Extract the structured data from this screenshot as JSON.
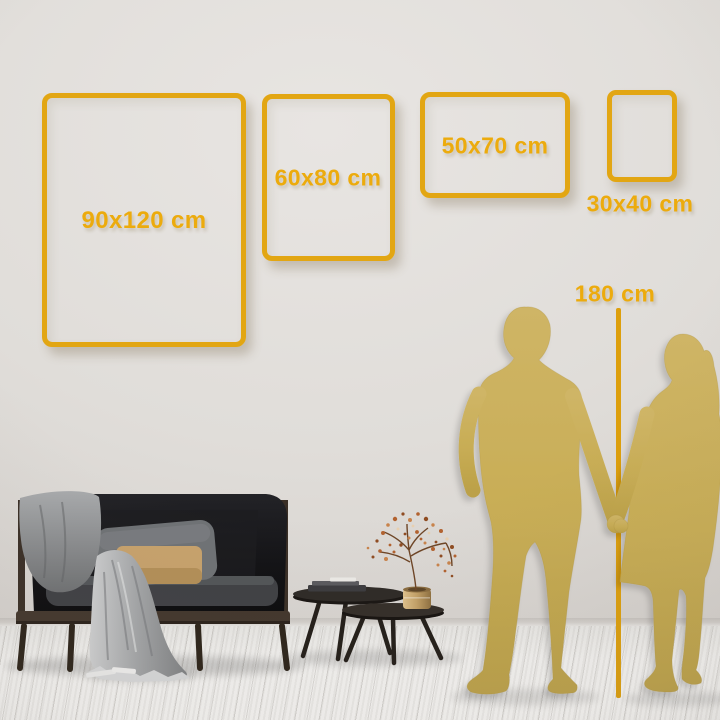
{
  "page": {
    "type": "wall-art-size-comparison-guide",
    "setting": "living room wall with sofa, coffee tables and couple silhouettes for scale"
  },
  "sizes": [
    {
      "label": "90x120 cm",
      "width_cm": 90,
      "height_cm": 120
    },
    {
      "label": "60x80 cm",
      "width_cm": 60,
      "height_cm": 80
    },
    {
      "label": "50x70 cm",
      "width_cm": 50,
      "height_cm": 70
    },
    {
      "label": "30x40 cm",
      "width_cm": 30,
      "height_cm": 40
    }
  ],
  "height_marker": {
    "label": "180 cm",
    "value_cm": 180
  },
  "colors": {
    "accent_gold": "#E2A613",
    "label_gold": "#ECAB0D",
    "silhouette_gold": "#C8AD55",
    "wall": "#DEDAD6",
    "floor": "#F2F1EF"
  }
}
